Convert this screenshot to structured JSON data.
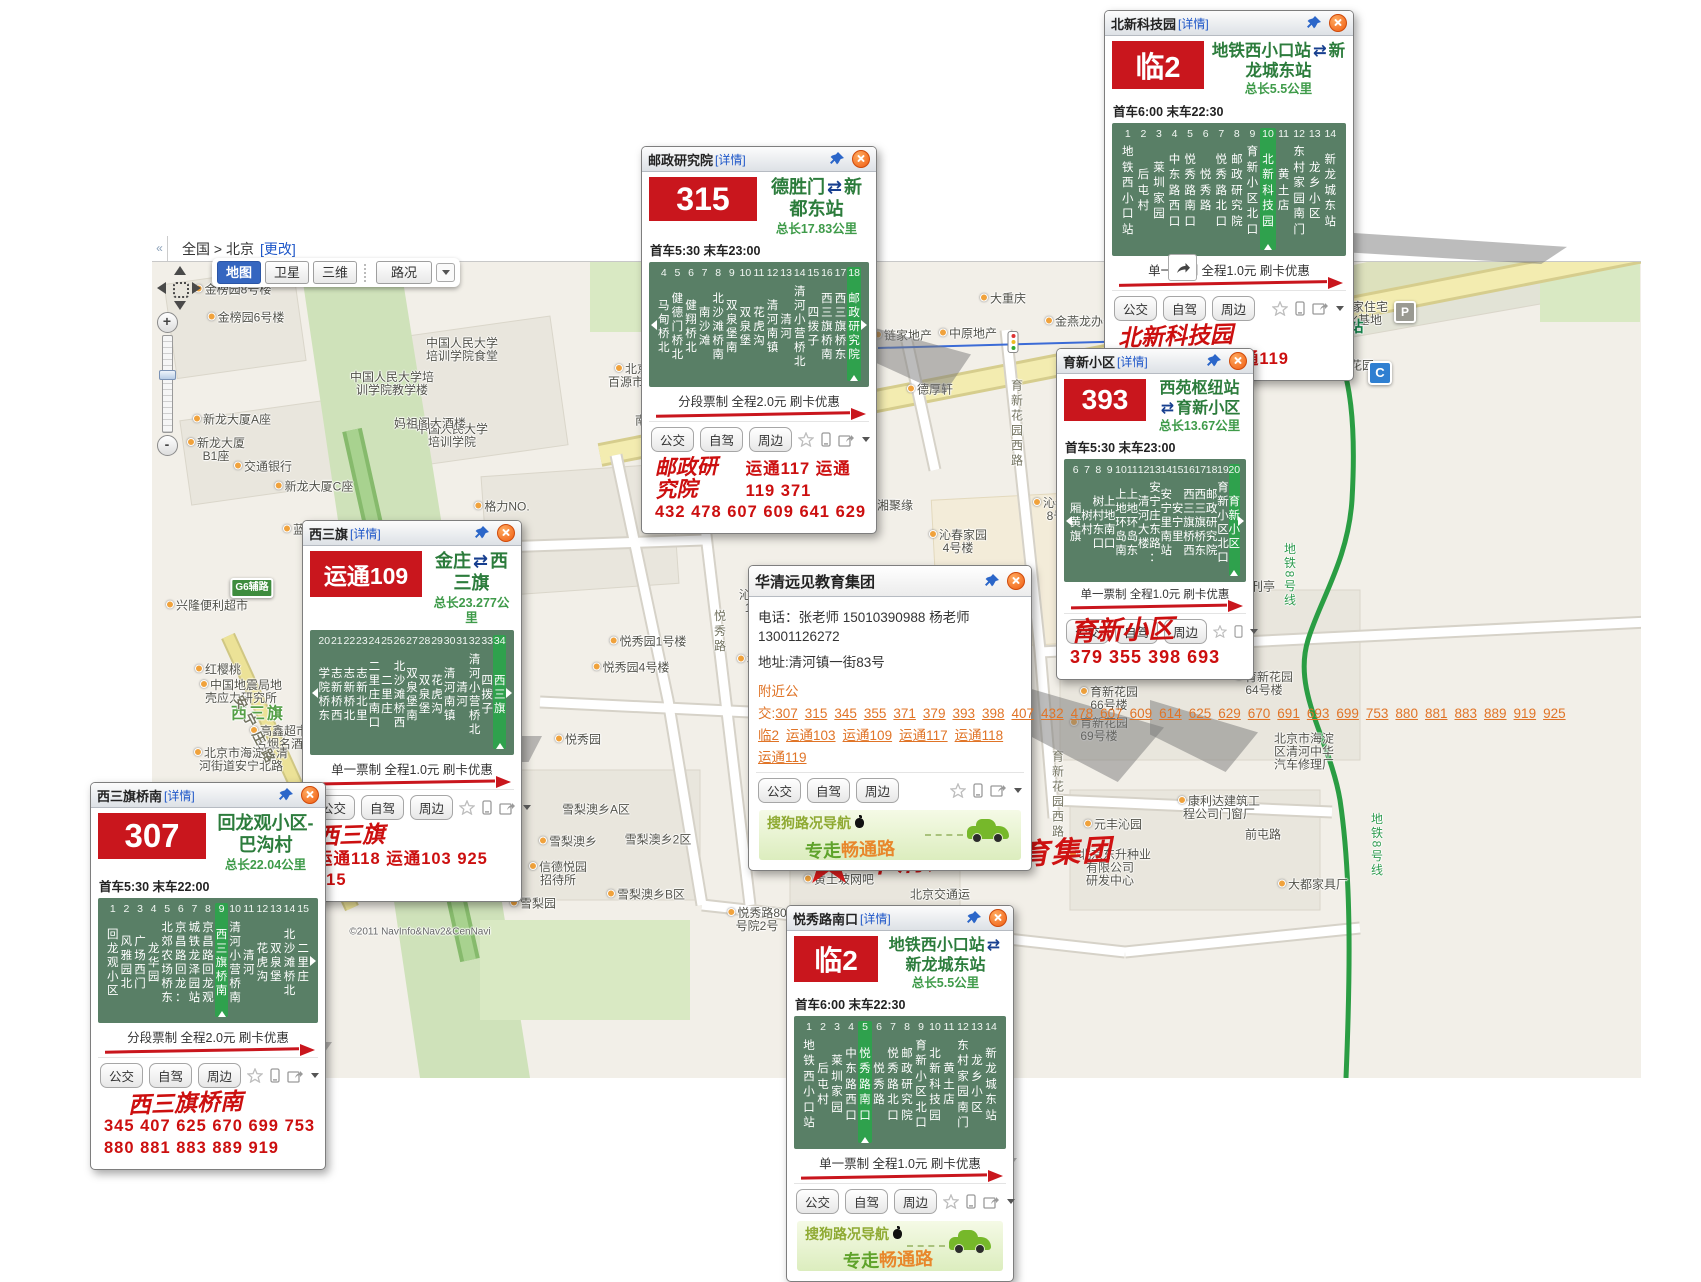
{
  "chrome": {
    "collapse": "«",
    "breadcrumb": "全国 > 北京",
    "change": "[更改]",
    "map_btn": "地图",
    "satellite_btn": "卫星",
    "three_d_btn": "三维",
    "traffic_btn": "路况",
    "fullscreen": "全屏",
    "zoom_in": "+",
    "zoom_out": "-"
  },
  "ad": {
    "brand": "搜狗路况导航",
    "slogan_a": "专走",
    "slogan_b": "畅通路"
  },
  "marker": {
    "pin": "1",
    "label": "华清远见教育集团"
  },
  "map": {
    "copyright": "©2011 NavInfo&Nav2&CenNavi",
    "badges": [
      {
        "x": 1293,
        "y": 306,
        "t": "A",
        "cls": "blue"
      },
      {
        "x": 1300,
        "y": 347,
        "t": "D",
        "cls": "blue"
      },
      {
        "x": 1380,
        "y": 373,
        "t": "C",
        "cls": "blue"
      },
      {
        "x": 1405,
        "y": 312,
        "t": "P",
        "cls": "grey"
      },
      {
        "x": 1316,
        "y": 328,
        "t": "",
        "cls": "metro"
      },
      {
        "x": 252,
        "y": 588,
        "t": "G6辅路",
        "cls": "green"
      },
      {
        "x": 379,
        "y": 826,
        "t": "G6",
        "cls": "green"
      }
    ],
    "labels": [
      {
        "x": 233,
        "y": 290,
        "t": "金榜园8号楼",
        "dot": 1
      },
      {
        "x": 246,
        "y": 318,
        "t": "金榜园6号楼",
        "dot": 1
      },
      {
        "x": 462,
        "y": 350,
        "t": "中国人民大学\n培训学院食堂"
      },
      {
        "x": 392,
        "y": 384,
        "t": "中国人民大学培\n训学院教学楼"
      },
      {
        "x": 232,
        "y": 420,
        "t": "新龙大厦A座",
        "dot": 1
      },
      {
        "x": 452,
        "y": 436,
        "t": "中国人民大学\n培训学院"
      },
      {
        "x": 216,
        "y": 450,
        "t": "新龙大厦\nB1座",
        "dot": 1
      },
      {
        "x": 263,
        "y": 467,
        "t": "交通银行",
        "dot": 1
      },
      {
        "x": 314,
        "y": 487,
        "t": "新龙大厦C座",
        "dot": 1
      },
      {
        "x": 430,
        "y": 424,
        "t": "妈祖阁大酒楼"
      },
      {
        "x": 502,
        "y": 507,
        "t": "格力NO.",
        "dot": 1
      },
      {
        "x": 632,
        "y": 376,
        "t": "北京\n百源市场",
        "dot": 1
      },
      {
        "x": 700,
        "y": 521,
        "t": "巫山烤鱼",
        "dot": 1
      },
      {
        "x": 890,
        "y": 506,
        "t": "湘聚缘",
        "dot": 1
      },
      {
        "x": 1062,
        "y": 510,
        "t": "沁春家园\n8号楼",
        "dot": 1
      },
      {
        "x": 958,
        "y": 542,
        "t": "沁春家园\n4号楼",
        "dot": 1
      },
      {
        "x": 1160,
        "y": 540,
        "t": "沁春家园",
        "cls": "big-red"
      },
      {
        "x": 1103,
        "y": 590,
        "t": "沁春家园\n6号楼",
        "dot": 1
      },
      {
        "x": 1198,
        "y": 594,
        "t": "沁春家园\n10号楼",
        "dot": 1
      },
      {
        "x": 763,
        "y": 602,
        "t": "沁春家园\n11号楼"
      },
      {
        "x": 300,
        "y": 530,
        "t": "蓝调",
        "dot": 1
      },
      {
        "x": 207,
        "y": 606,
        "t": "兴隆便利超市",
        "dot": 1
      },
      {
        "x": 218,
        "y": 670,
        "t": "红樱桃",
        "dot": 1
      },
      {
        "x": 241,
        "y": 692,
        "t": "中国地震局地\n壳应力研究所",
        "dot": 1
      },
      {
        "x": 279,
        "y": 738,
        "t": "高鑫超市\n名烟名酒",
        "dot": 1
      },
      {
        "x": 241,
        "y": 760,
        "t": "北京市海淀区清\n河街道安宁北路",
        "dot": 1
      },
      {
        "x": 258,
        "y": 714,
        "t": "西三旗",
        "cls": "big-green"
      },
      {
        "x": 415,
        "y": 842,
        "t": "环三旗建材城"
      },
      {
        "x": 558,
        "y": 874,
        "t": "信德悦园\n招待所",
        "dot": 1
      },
      {
        "x": 596,
        "y": 810,
        "t": "雪梨澳乡A区"
      },
      {
        "x": 568,
        "y": 842,
        "t": "雪梨澳乡",
        "dot": 1
      },
      {
        "x": 658,
        "y": 840,
        "t": "雪梨澳乡2区"
      },
      {
        "x": 533,
        "y": 904,
        "t": "雪梨园",
        "dot": 1
      },
      {
        "x": 646,
        "y": 895,
        "t": "雪梨澳乡B区",
        "dot": 1
      },
      {
        "x": 578,
        "y": 740,
        "t": "悦秀园",
        "dot": 1
      },
      {
        "x": 648,
        "y": 642,
        "t": "悦秀园1号楼",
        "dot": 1
      },
      {
        "x": 631,
        "y": 668,
        "t": "悦秀园4号楼",
        "dot": 1
      },
      {
        "x": 748,
        "y": 660,
        "t": "林",
        "dot": 1
      },
      {
        "x": 793,
        "y": 825,
        "t": "金满缘",
        "dot": 1
      },
      {
        "x": 839,
        "y": 880,
        "t": "黄土坡网吧",
        "dot": 1
      },
      {
        "x": 940,
        "y": 895,
        "t": "北京交通运"
      },
      {
        "x": 757,
        "y": 920,
        "t": "悦秀路80\n号院2号",
        "dot": 1
      },
      {
        "x": 659,
        "y": 421,
        "t": "南店新村"
      },
      {
        "x": 930,
        "y": 390,
        "t": "德厚轩",
        "dot": 1
      },
      {
        "x": 903,
        "y": 336,
        "t": "链家地产",
        "dot": 1
      },
      {
        "x": 968,
        "y": 334,
        "t": "中原地产",
        "dot": 1
      },
      {
        "x": 1003,
        "y": 299,
        "t": "大重庆",
        "dot": 1
      },
      {
        "x": 1086,
        "y": 322,
        "t": "金燕龙办公楼",
        "dot": 1
      },
      {
        "x": 1176,
        "y": 284,
        "t": "柏瑞安\n技大厦",
        "dot": 1
      },
      {
        "x": 750,
        "y": 492,
        "t": "北京城建五建\n设计公司\n综合加工厂"
      },
      {
        "x": 1352,
        "y": 314,
        "t": "北新国家住宅\n产业化基地"
      },
      {
        "x": 1345,
        "y": 366,
        "t": "育新花园",
        "dot": 1
      },
      {
        "x": 1341,
        "y": 327,
        "t": "育新站",
        "cls": "metro-station"
      },
      {
        "x": 1252,
        "y": 587,
        "t": "报刊亭",
        "dot": 1
      },
      {
        "x": 1094,
        "y": 604,
        "t": "鸿达便利店",
        "dot": 1
      },
      {
        "x": 1221,
        "y": 618,
        "t": "育新花园\n51号楼",
        "dot": 1
      },
      {
        "x": 1088,
        "y": 645,
        "t": "育新南路"
      },
      {
        "x": 1186,
        "y": 654,
        "t": "育新南区\n邮政所",
        "dot": 1
      },
      {
        "x": 1264,
        "y": 684,
        "t": "育新花园\n64号楼",
        "dot": 1
      },
      {
        "x": 1109,
        "y": 699,
        "t": "育新花园\n66号楼",
        "dot": 1
      },
      {
        "x": 1099,
        "y": 730,
        "t": "育新花园\n69号楼",
        "dot": 1
      },
      {
        "x": 1219,
        "y": 808,
        "t": "康利达建筑工\n程公司门窗厂",
        "dot": 1
      },
      {
        "x": 1263,
        "y": 835,
        "t": "前屯路"
      },
      {
        "x": 1113,
        "y": 825,
        "t": "元丰沁园",
        "dot": 1
      },
      {
        "x": 1110,
        "y": 868,
        "t": "北京东升种业\n有限公司\n研发中心",
        "dot": 1
      },
      {
        "x": 1313,
        "y": 885,
        "t": "大都家具厂",
        "dot": 1
      },
      {
        "x": 1304,
        "y": 752,
        "t": "北京市海淀\n区清河中华\n汽车修理厂"
      },
      {
        "x": 790,
        "y": 398,
        "t": "建材城西路",
        "cls": "road",
        "rot": -11
      },
      {
        "x": 1190,
        "y": 316,
        "t": "建材城西路",
        "cls": "road",
        "rot": -12
      },
      {
        "x": 256,
        "y": 732,
        "t": "安宁庄路",
        "cls": "road",
        "rot": 63
      },
      {
        "x": 719,
        "y": 632,
        "t": "悦秀路",
        "cls": "road-v"
      },
      {
        "x": 1016,
        "y": 424,
        "t": "育新花园西路",
        "cls": "road-v"
      },
      {
        "x": 1057,
        "y": 795,
        "t": "育新花园西路",
        "cls": "road-v"
      },
      {
        "x": 1289,
        "y": 575,
        "t": "地铁8号线",
        "cls": "metro-v"
      },
      {
        "x": 1376,
        "y": 845,
        "t": "地铁8号线",
        "cls": "metro-v"
      },
      {
        "x": 420,
        "y": 932,
        "t": "©2011 NavInfo&Nav2&CenNavi",
        "cls": "copyright"
      }
    ]
  },
  "popups": {
    "beixin": {
      "title": "北新科技园",
      "detail_link": "[详情]",
      "route_no": "临2",
      "from": "地铁西小口站",
      "arrow": "⇄",
      "to": "新龙城东站",
      "length": "总长5.5公里",
      "schedule": "首车6:00  末车22:30",
      "highlight": 10,
      "stops": [
        {
          "n": 1,
          "name": "地铁西小口站"
        },
        {
          "n": 2,
          "name": "后屯村"
        },
        {
          "n": 3,
          "name": "莱圳家园"
        },
        {
          "n": 4,
          "name": "中东路西口"
        },
        {
          "n": 5,
          "name": "悦秀路南口"
        },
        {
          "n": 6,
          "name": "悦秀路"
        },
        {
          "n": 7,
          "name": "悦秀路北口"
        },
        {
          "n": 8,
          "name": "邮政研究院"
        },
        {
          "n": 9,
          "name": "育新小区北口"
        },
        {
          "n": 10,
          "name": "北新科技园"
        },
        {
          "n": 11,
          "name": "黄土店"
        },
        {
          "n": 12,
          "name": "东村家园南门"
        },
        {
          "n": 13,
          "name": "龙乡小区"
        },
        {
          "n": 14,
          "name": "新龙城东站"
        }
      ],
      "fare": "单一票制 全程1.0元 刷卡优惠",
      "buttons": [
        "公交",
        "自驾",
        "周边"
      ],
      "red_title": "北新科技园",
      "red_lines": [
        "315  运通117  运通119"
      ]
    },
    "youzheng": {
      "title": "邮政研究院",
      "detail_link": "[详情]",
      "route_no": "315",
      "from": "德胜门",
      "arrow": "⇄",
      "to": "新都东站",
      "length": "总长17.83公里",
      "schedule": "首车5:30  末车23:00",
      "highlight": 18,
      "stops": [
        {
          "n": 4,
          "name": "马甸桥北"
        },
        {
          "n": 5,
          "name": "健德门桥北"
        },
        {
          "n": 6,
          "name": "健翔桥北"
        },
        {
          "n": 7,
          "name": "南沙滩"
        },
        {
          "n": 8,
          "name": "北沙滩桥南"
        },
        {
          "n": 9,
          "name": "双泉堡南"
        },
        {
          "n": 10,
          "name": "双泉堡"
        },
        {
          "n": 11,
          "name": "花虎沟"
        },
        {
          "n": 12,
          "name": "清河南镇"
        },
        {
          "n": 13,
          "name": "清河"
        },
        {
          "n": 14,
          "name": "清河小营桥北"
        },
        {
          "n": 15,
          "name": "四拨子"
        },
        {
          "n": 16,
          "name": "西三旗桥南"
        },
        {
          "n": 17,
          "name": "西三旗桥东"
        },
        {
          "n": 18,
          "name": "邮政研究院"
        }
      ],
      "fare": "分段票制 全程2.0元 刷卡优惠",
      "buttons": [
        "公交",
        "自驾",
        "周边"
      ],
      "red_title": "邮政研究院",
      "red_inline": "运通117  运通119  371",
      "red_line2": "432   478   607   609   641   629"
    },
    "yuxin": {
      "title": "育新小区",
      "detail_link": "[详情]",
      "route_no": "393",
      "from": "西苑枢纽站",
      "arrow": "⇄",
      "to": "育新小区",
      "length": "总长13.67公里",
      "schedule": "首车5:30  末车23:00",
      "highlight": 20,
      "stops": [
        {
          "n": 6,
          "name": "厢黄旗"
        },
        {
          "n": 7,
          "name": "树村"
        },
        {
          "n": 8,
          "name": "树村东口"
        },
        {
          "n": 9,
          "name": "上地南口"
        },
        {
          "n": 10,
          "name": "上地环岛南"
        },
        {
          "n": 11,
          "name": "上地环岛东"
        },
        {
          "n": 12,
          "name": "清河大楼"
        },
        {
          "n": 13,
          "name": "安宁庄东路："
        },
        {
          "n": 14,
          "name": "安宁里南站"
        },
        {
          "n": 15,
          "name": "安宁里"
        },
        {
          "n": 16,
          "name": "西三旗桥西"
        },
        {
          "n": 17,
          "name": "西三旗桥东"
        },
        {
          "n": 18,
          "name": "邮政研究院"
        },
        {
          "n": 19,
          "name": "育新小区北口"
        },
        {
          "n": 20,
          "name": "育新小区"
        }
      ],
      "fare": "单一票制 全程1.0元 刷卡优惠",
      "buttons": [
        "公交",
        "自驾",
        "周边"
      ],
      "red_title": "育新小区",
      "red_lines": [
        "379   355   398   693"
      ]
    },
    "xisanqi": {
      "title": "西三旗",
      "detail_link": "[详情]",
      "route_no": "运通109",
      "from": "金庄",
      "arrow": "⇄",
      "to": "西三旗",
      "length": "总长23.277公里",
      "highlight": 34,
      "stops": [
        {
          "n": 20,
          "name": "学院桥东"
        },
        {
          "n": 21,
          "name": "志新桥西"
        },
        {
          "n": 22,
          "name": "志新桥北"
        },
        {
          "n": 23,
          "name": "志新北里"
        },
        {
          "n": 24,
          "name": "二里庄南口"
        },
        {
          "n": 25,
          "name": "二里庄"
        },
        {
          "n": 26,
          "name": "北沙滩桥西"
        },
        {
          "n": 27,
          "name": "双泉堡南"
        },
        {
          "n": 28,
          "name": "双泉堡"
        },
        {
          "n": 29,
          "name": "花虎沟"
        },
        {
          "n": 30,
          "name": "清河南镇"
        },
        {
          "n": 31,
          "name": "清河"
        },
        {
          "n": 32,
          "name": "清河小营桥北"
        },
        {
          "n": 33,
          "name": "四拨子"
        },
        {
          "n": 34,
          "name": "西三旗"
        }
      ],
      "fare": "单一票制 全程1.0元 刷卡优惠",
      "buttons": [
        "公交",
        "自驾",
        "周边"
      ],
      "red_title": "西三旗",
      "red_lines": [
        "运通118  运通103   925  315"
      ]
    },
    "qiaonan": {
      "title": "西三旗桥南",
      "detail_link": "[详情]",
      "route_no": "307",
      "from": "回龙观小区-巴沟村",
      "arrow": "",
      "to": "",
      "length": "总长22.04公里",
      "schedule": "首车5:30  末车22:00",
      "highlight": 9,
      "stops": [
        {
          "n": 1,
          "name": "回龙观小区"
        },
        {
          "n": 2,
          "name": "风雅园北"
        },
        {
          "n": 3,
          "name": "广场西门"
        },
        {
          "n": 4,
          "name": "龙华园"
        },
        {
          "n": 5,
          "name": "北郊农场桥东"
        },
        {
          "n": 6,
          "name": "京昌路回龙："
        },
        {
          "n": 7,
          "name": "城铁龙泽园站"
        },
        {
          "n": 8,
          "name": "京昌路回龙观"
        },
        {
          "n": 9,
          "name": "西三旗桥南"
        },
        {
          "n": 10,
          "name": "清河小营桥南"
        },
        {
          "n": 11,
          "name": "清河"
        },
        {
          "n": 12,
          "name": "花虎沟"
        },
        {
          "n": 13,
          "name": "双泉堡"
        },
        {
          "n": 14,
          "name": "北沙滩桥北"
        },
        {
          "n": 15,
          "name": "二里庄"
        }
      ],
      "fare": "分段票制 全程2.0元 刷卡优惠",
      "buttons": [
        "公交",
        "自驾",
        "周边"
      ],
      "red_title": "西三旗桥南",
      "red_lines": [
        "345  407  625   670  699  753",
        "880   881  883   889   919"
      ]
    },
    "yuexiu": {
      "title": "悦秀路南口",
      "detail_link": "[详情]",
      "route_no": "临2",
      "from": "地铁西小口站",
      "arrow": "⇄",
      "to": "新龙城东站",
      "length": "总长5.5公里",
      "schedule": "首车6:00  末车22:30",
      "highlight": 5,
      "stops": [
        {
          "n": 1,
          "name": "地铁西小口站"
        },
        {
          "n": 2,
          "name": "后屯村"
        },
        {
          "n": 3,
          "name": "莱圳家园"
        },
        {
          "n": 4,
          "name": "中东路西口"
        },
        {
          "n": 5,
          "name": "悦秀路南口"
        },
        {
          "n": 6,
          "name": "悦秀路"
        },
        {
          "n": 7,
          "name": "悦秀路北口"
        },
        {
          "n": 8,
          "name": "邮政研究院"
        },
        {
          "n": 9,
          "name": "育新小区北口"
        },
        {
          "n": 10,
          "name": "北新科技园"
        },
        {
          "n": 11,
          "name": "黄土店"
        },
        {
          "n": 12,
          "name": "东村家园南门"
        },
        {
          "n": 13,
          "name": "龙乡小区"
        },
        {
          "n": 14,
          "name": "新龙城东站"
        }
      ],
      "fare": "单一票制 全程1.0元 刷卡优惠",
      "buttons": [
        "公交",
        "自驾",
        "周边"
      ]
    },
    "huaqing": {
      "title": "华清远见教育集团",
      "phone_label": "电话：",
      "phone": "张老师  15010390988  杨老师  13001126272",
      "addr_label": "地址:",
      "addr": "清河镇一街83号",
      "nearby_label": "附近公交:",
      "links": [
        "307",
        "315",
        "345",
        "355",
        "371",
        "379",
        "393",
        "398",
        "407",
        "432",
        "478",
        "607",
        "609",
        "614",
        "625",
        "629",
        "670",
        "691",
        "693",
        "699",
        "753",
        "880",
        "881",
        "883",
        "889",
        "919",
        "925",
        "临2",
        "运通103",
        "运通109",
        "运通117",
        "运通118",
        "运通119"
      ],
      "buttons": [
        "公交",
        "自驾",
        "周边"
      ]
    }
  }
}
